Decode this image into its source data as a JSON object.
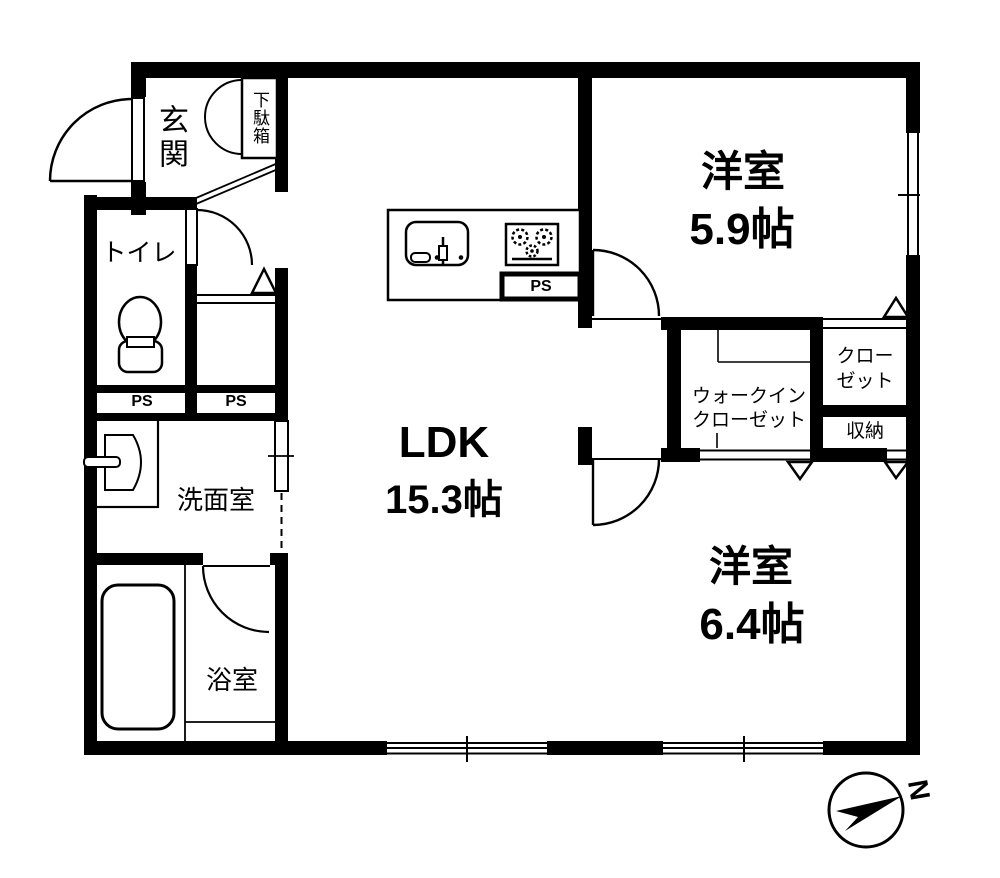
{
  "colors": {
    "wall": "#000000",
    "background": "#ffffff",
    "line": "#000000"
  },
  "rooms": {
    "entrance": {
      "label": "玄関"
    },
    "shoe_cabinet": {
      "label": "下駄箱"
    },
    "toilet": {
      "label": "トイレ"
    },
    "washroom": {
      "label": "洗面室"
    },
    "bathroom": {
      "label": "浴室"
    },
    "ldk": {
      "label": "LDK",
      "size": "15.3帖"
    },
    "bedroom_1": {
      "label": "洋室",
      "size": "5.9帖"
    },
    "bedroom_2": {
      "label": "洋室",
      "size": "6.4帖"
    },
    "walk_in_closet": {
      "label_line1": "ウォークイン",
      "label_line2": "クローゼット"
    },
    "closet": {
      "label_line1": "クロー",
      "label_line2": "ゼット"
    },
    "storage": {
      "label": "収納"
    }
  },
  "pipe_spaces": {
    "toilet_ps": "PS",
    "hall_ps": "PS",
    "kitchen_ps": "PS"
  },
  "compass": {
    "north": "N"
  }
}
